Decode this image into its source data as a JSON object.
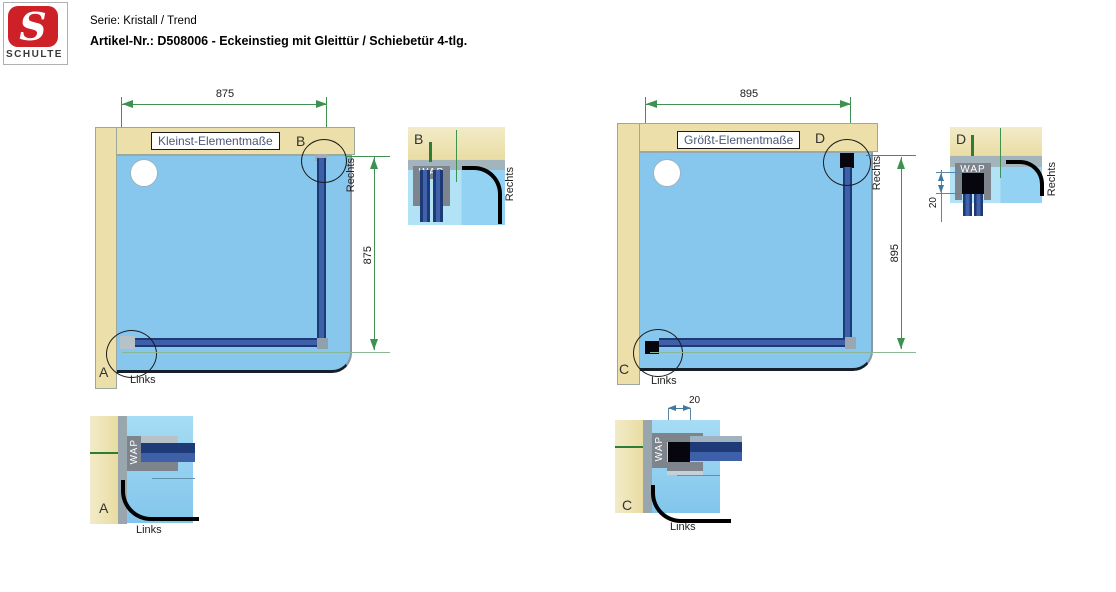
{
  "header": {
    "logo_letter": "S",
    "logo_brand": "SCHULTE",
    "series": "Serie: Kristall / Trend",
    "article": "Artikel-Nr.: D508006 - Eckeinstieg mit Gleittür / Schiebetür 4-tlg."
  },
  "colors": {
    "accent_red": "#ce2127",
    "dimension_green": "#3f9152",
    "detail_dimension_teal": "#41789f",
    "wall_beige": "#ecdfa9",
    "tray_blue": "#87c7ee",
    "profile_navy": "#1d3a76",
    "profile_gray": "#7d848c",
    "extension_black": "#06060c"
  },
  "left_diagram": {
    "title": "Kleinst-Elementmaße",
    "width_dim": "875",
    "height_dim": "875",
    "corner_top_label": "B",
    "corner_bottom_label": "A",
    "bottom_side_label": "Links",
    "right_side_label": "Rechts"
  },
  "right_diagram": {
    "title": "Größt-Elementmaße",
    "width_dim": "895",
    "height_dim": "895",
    "corner_top_label": "D",
    "corner_bottom_label": "C",
    "bottom_side_label": "Links",
    "right_side_label": "Rechts"
  },
  "detail_b": {
    "label": "B",
    "profile_label": "WAP",
    "side_label": "Rechts"
  },
  "detail_d": {
    "label": "D",
    "profile_label": "WAP",
    "side_label": "Rechts",
    "extension_dim": "20"
  },
  "detail_a": {
    "label": "A",
    "profile_label": "WAP",
    "side_label": "Links"
  },
  "detail_c": {
    "label": "C",
    "profile_label": "WAP",
    "side_label": "Links",
    "extension_dim": "20"
  }
}
